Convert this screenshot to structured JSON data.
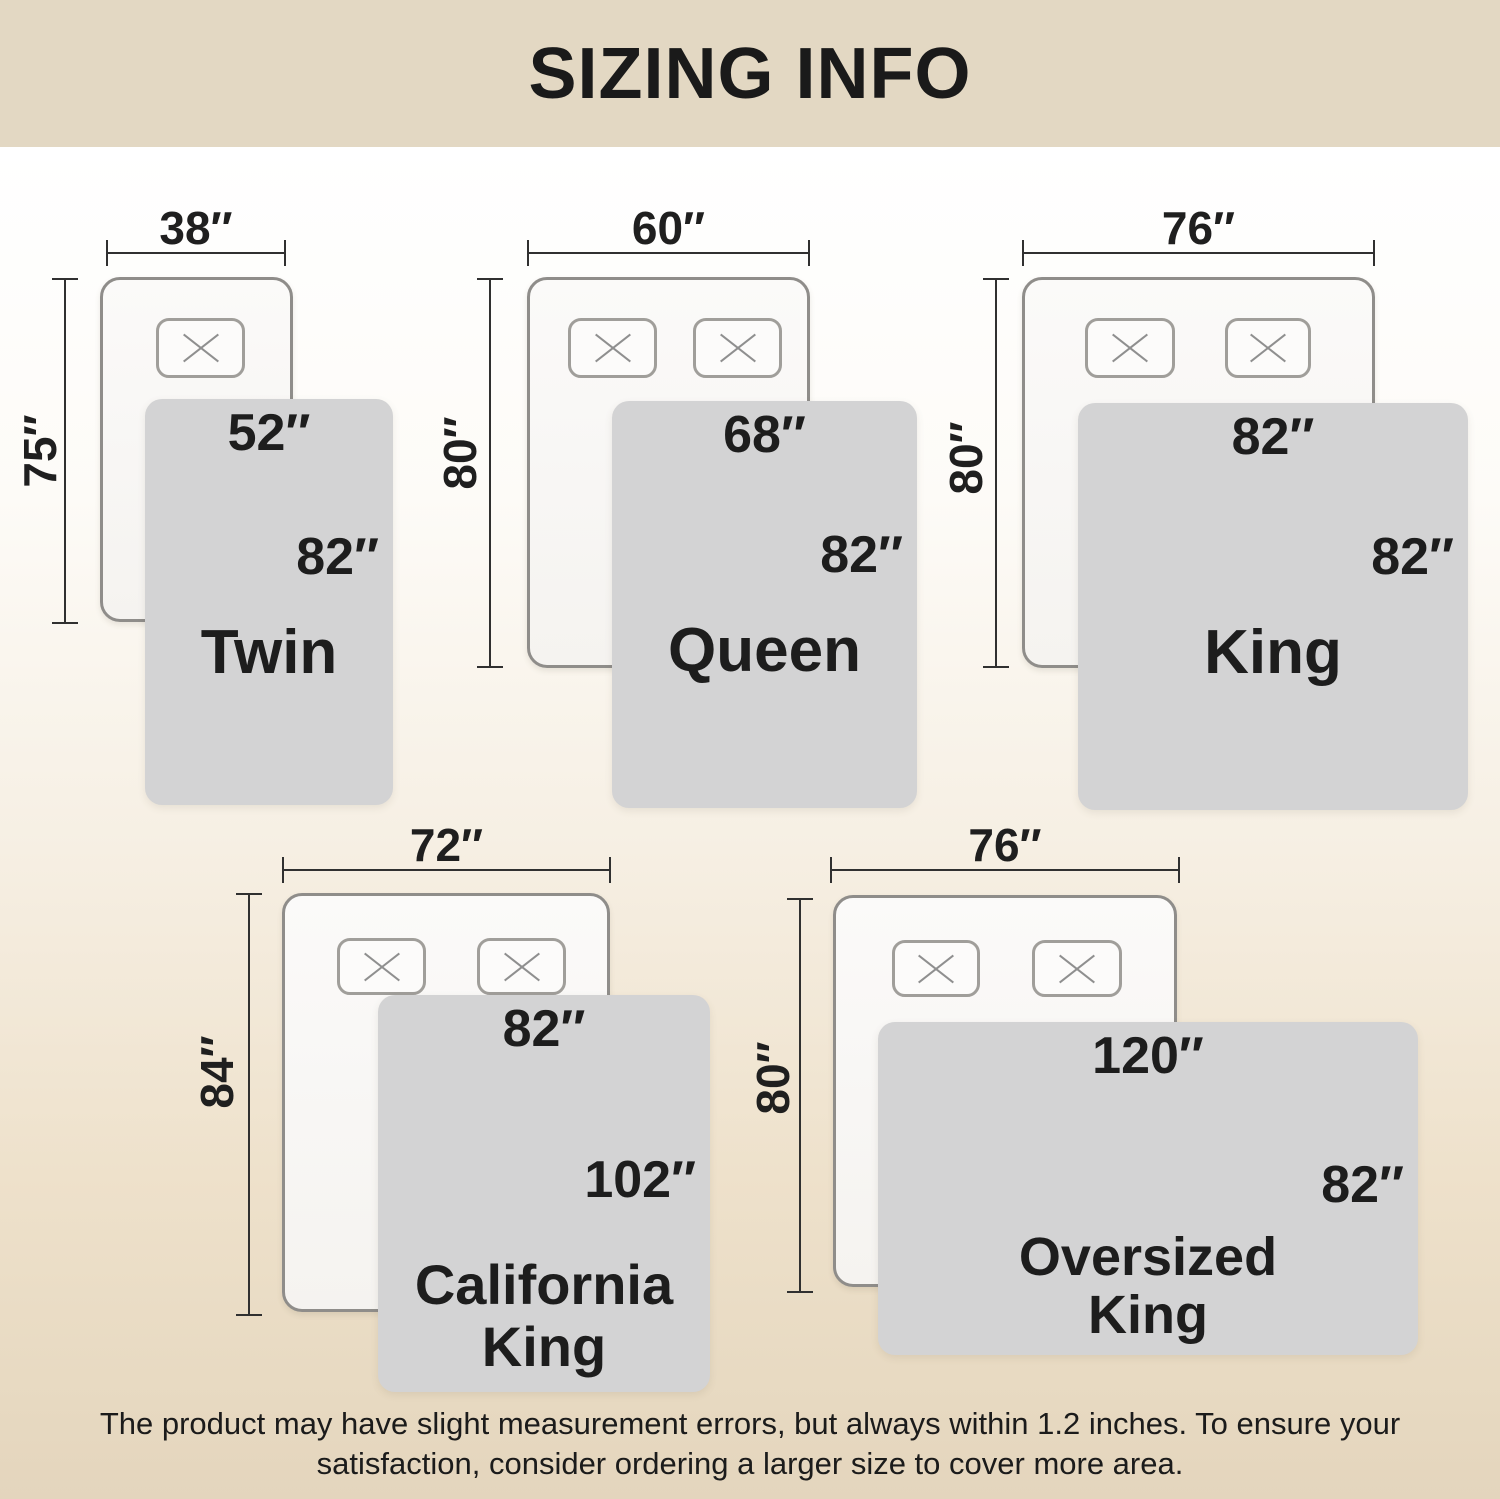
{
  "title": "SIZING INFO",
  "sizes": [
    {
      "name": "Twin",
      "bed_width": "38″",
      "bed_height": "75″",
      "blanket_width": "52″",
      "blanket_height": "82″"
    },
    {
      "name": "Queen",
      "bed_width": "60″",
      "bed_height": "80″",
      "blanket_width": "68″",
      "blanket_height": "82″"
    },
    {
      "name": "King",
      "bed_width": "76″",
      "bed_height": "80″",
      "blanket_width": "82″",
      "blanket_height": "82″"
    },
    {
      "name": "California King",
      "name_line1": "California",
      "name_line2": "King",
      "bed_width": "72″",
      "bed_height": "84″",
      "blanket_width": "82″",
      "blanket_height": "102″"
    },
    {
      "name": "Oversized King",
      "name_line1": "Oversized",
      "name_line2": "King",
      "bed_width": "76″",
      "bed_height": "80″",
      "blanket_width": "120″",
      "blanket_height": "82″"
    }
  ],
  "footer": {
    "line1": "The product may have slight measurement errors, but always within 1.2 inches. To ensure your",
    "line2": "satisfaction, consider ordering a larger size to cover more area."
  },
  "colors": {
    "header_bg": "#e3d8c3",
    "footer_bg": "#e4d5bd",
    "blanket_fill": "#d3d3d4",
    "bed_border": "#8f8d8a",
    "dim_line": "#303030",
    "text": "#1d1d1d"
  }
}
